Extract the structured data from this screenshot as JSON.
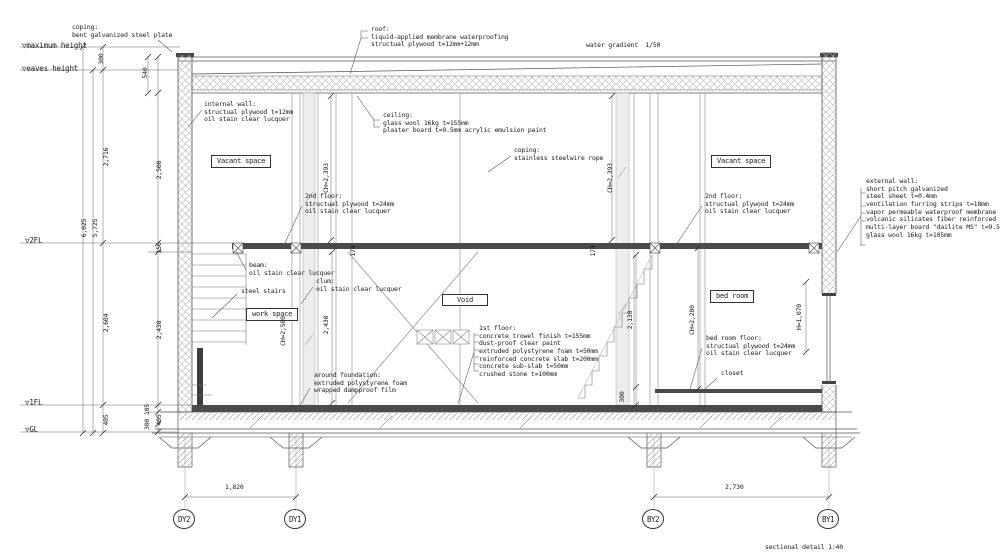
{
  "meta": {
    "footer": "sectional detail 1:40"
  },
  "levels": {
    "max": "▽maximum height",
    "eaves": "▽eaves height",
    "fl2": "▽2FL",
    "fl1": "▽1FL",
    "gl": "▽GL"
  },
  "rooms": {
    "vacant": "Vacant space",
    "work": "work space",
    "void": "Void",
    "bed": "bed room"
  },
  "ann": {
    "coping_top": "coping:\nbent galvanized steel plate",
    "roof": "roof:\nliquid-applied membrane waterproofing\nstructual plywood t=12mm+12mm",
    "water_gradient": "water gradient  1/50",
    "internal_wall": "internal wall:\nstructual plywood t=12mm\noil stain clear lucquer",
    "ceiling": "ceiling:\nglass wool 16kg t=155mm\nplaster board t=9.5mm acrylic emulsion paint",
    "coping_wire": "coping:\nstainless steelwire rope",
    "floor2": "2nd floor:\nstructual plywood t=24mm\noil stain clear lucquer",
    "external_wall": "external wall:\nshort pitch galvanized\nsteel sheet t=0.4mm\nventilation furring strips t=18mm\nvapor permeable waterproof membrane\nvolcanic silicates fiber reinforced\nmulti-layer board \"dailite MS\" t=9.5mm\nglass wool 16kg t=105mm",
    "beam": "beam:\noil stain clear lucquer",
    "steel_stairs": "steel stairs",
    "clum": "clum:\noil stain clear lucquer",
    "floor1": "1st floor:\nconcrete trowel finish t=155mm\ndust-proof clear paint\nextruded polystyrene foam t=50mm\nreinforced concrete slab t=200mm\nconcrete sub-slab t=50mm\ncrushed stone t=100mm",
    "around_foundation": "around foundation:\nextruded polystyrene foam\nwrapped dampproof film",
    "bedroom_floor": "bed room floor:\nstructual plywood t=24mm\noil stain clear lucquer",
    "closet": "closet"
  },
  "dims": {
    "v300": "300",
    "v540": "540",
    "v2716": "2,716",
    "v2500": "2,500",
    "v6025": "6,025",
    "v5725": "5,725",
    "v150": "150",
    "v2604": "2,604",
    "v2430": "2,430",
    "v405": "405",
    "v300_105": "300 105",
    "v174": "174",
    "v2130": "2,130",
    "v300b": "300",
    "h1820": "1,820",
    "h2730": "2,730"
  },
  "heights": {
    "ch2393": "CH=2,393",
    "ch2580": "CH=2,580",
    "ch2280": "CH=2,280",
    "h1070": "H=1,070"
  },
  "grid": {
    "dy2": "DY2",
    "dy1": "DY1",
    "by2": "BY2",
    "by1": "BY1"
  }
}
